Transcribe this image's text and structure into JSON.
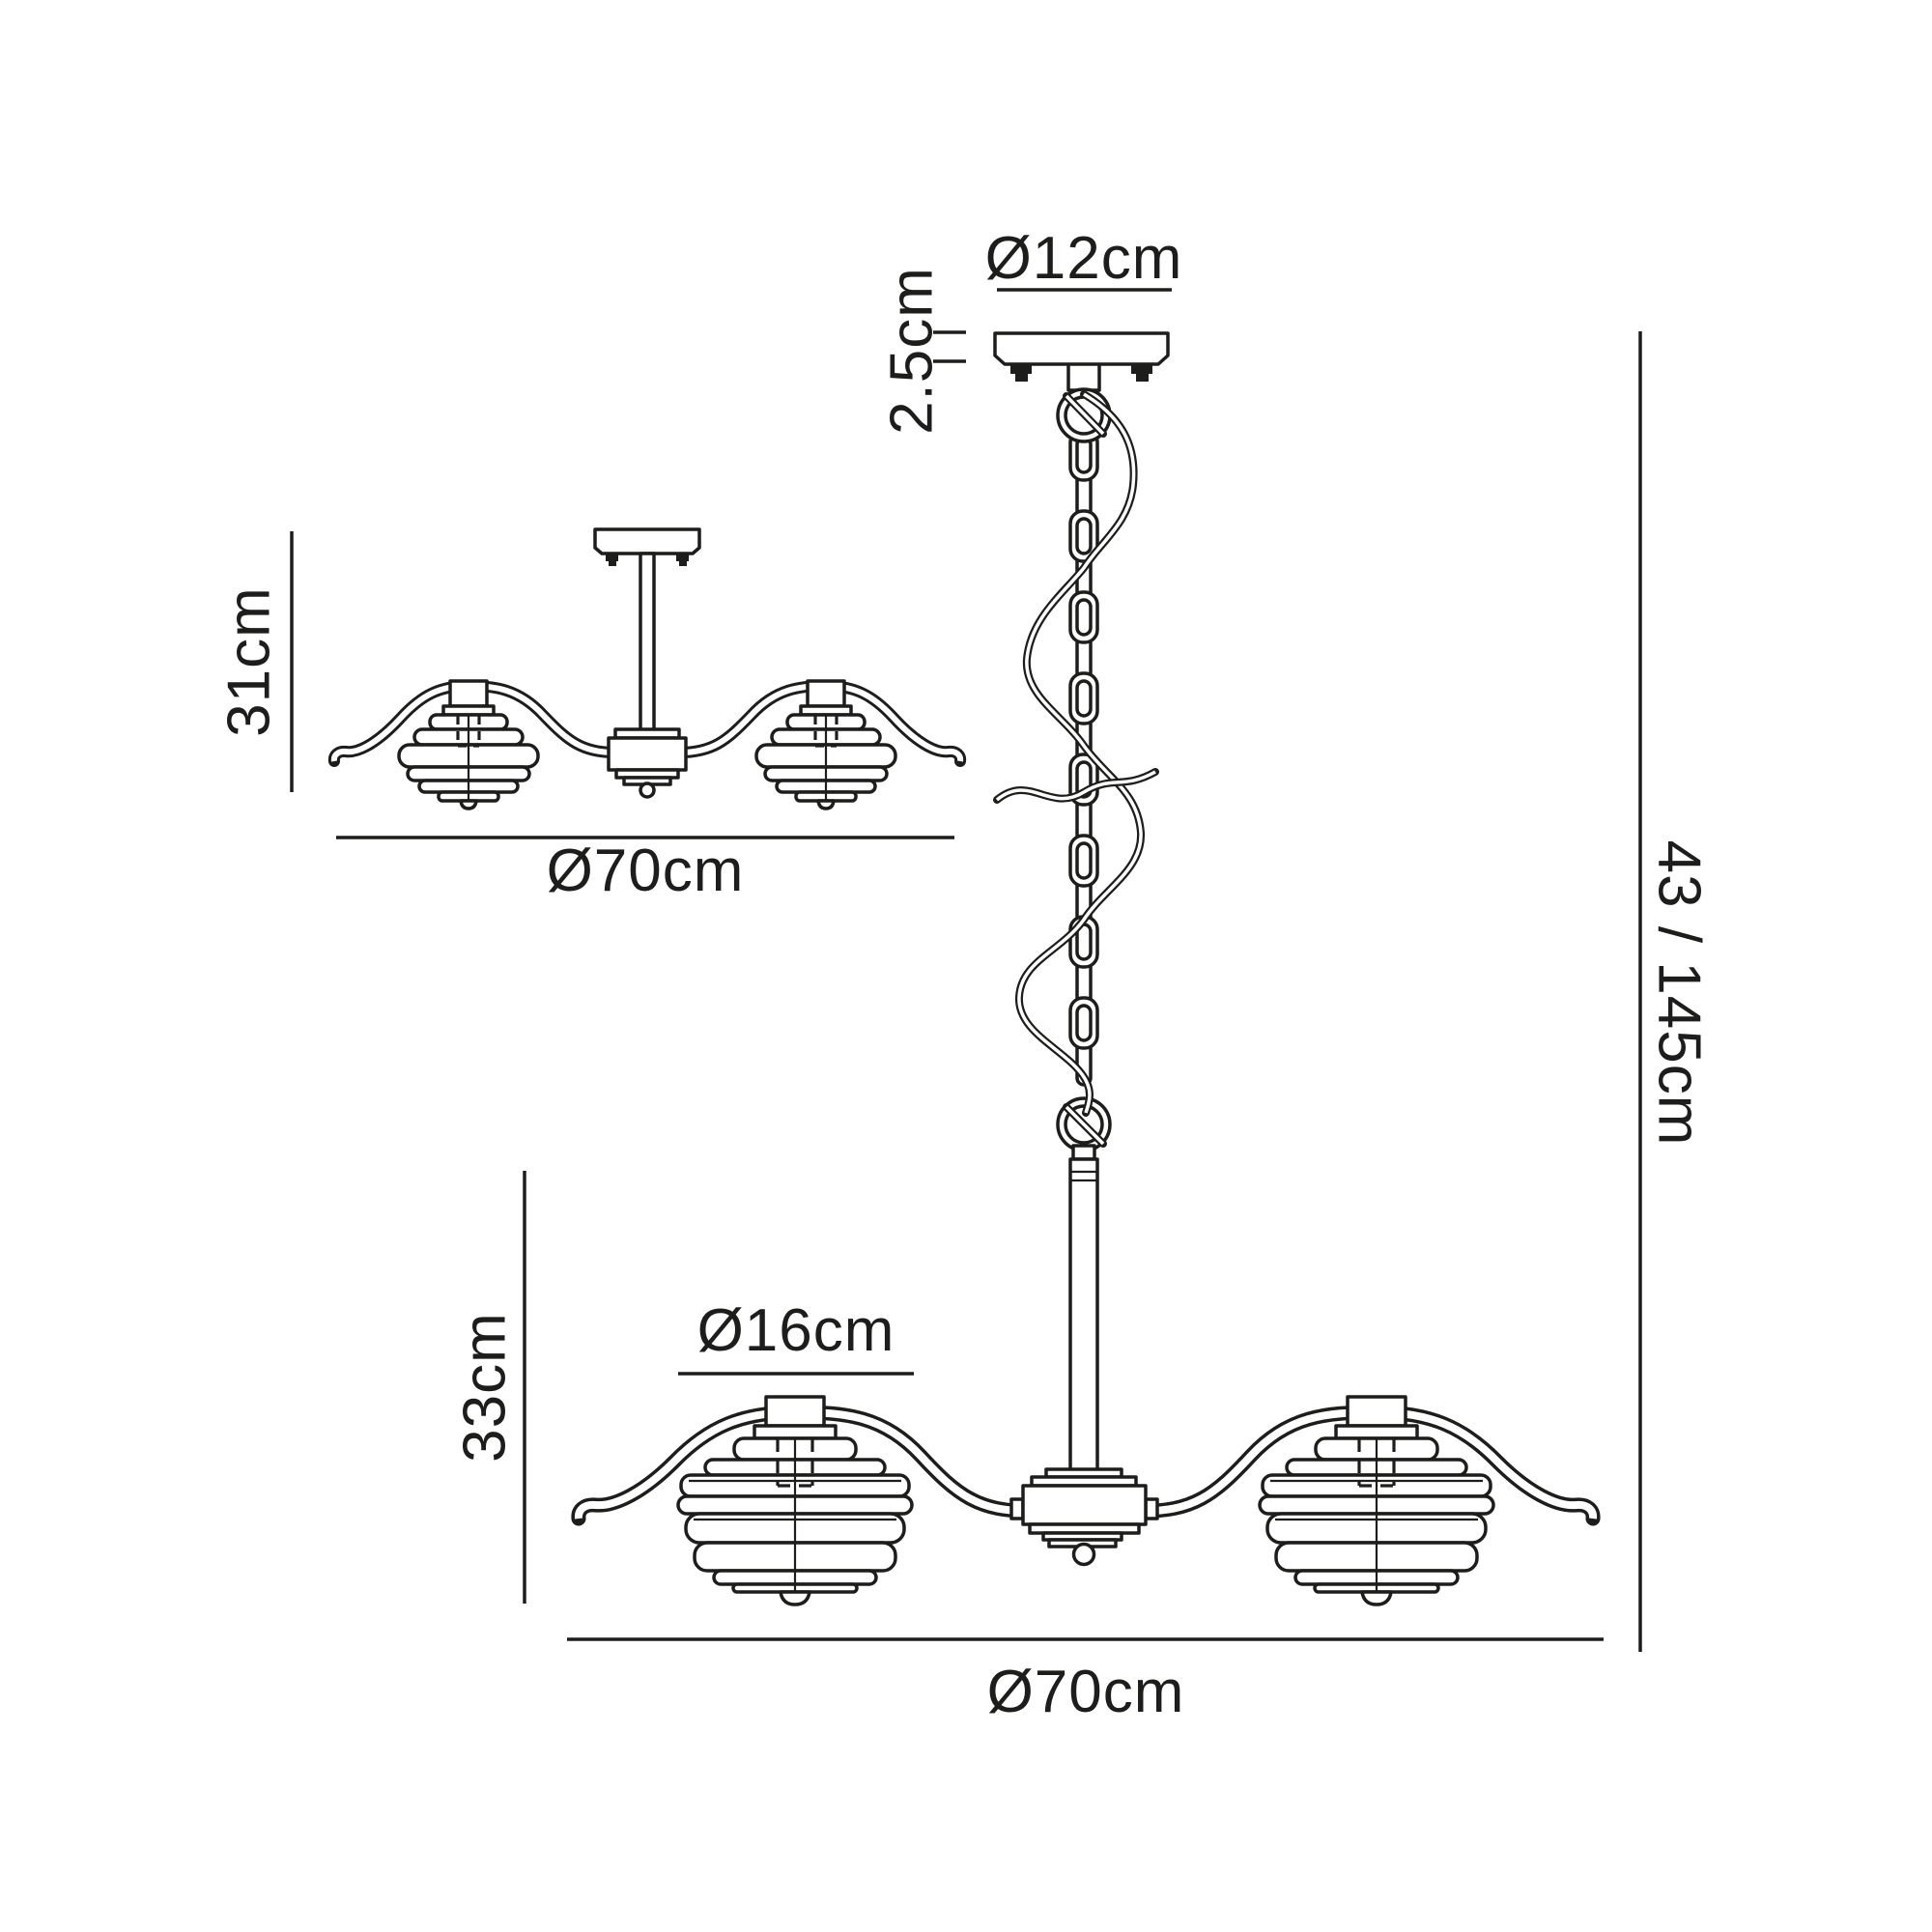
{
  "labels": {
    "canopy_diameter": "Ø12cm",
    "canopy_height": "2.5cm",
    "semiflush_height": "31cm",
    "semiflush_width": "Ø70cm",
    "total_height": "43 / 145cm",
    "shade_diameter": "Ø16cm",
    "body_height": "33cm",
    "pendant_width": "Ø70cm"
  },
  "colors": {
    "line": "#1d1d1b",
    "background": "#ffffff"
  }
}
